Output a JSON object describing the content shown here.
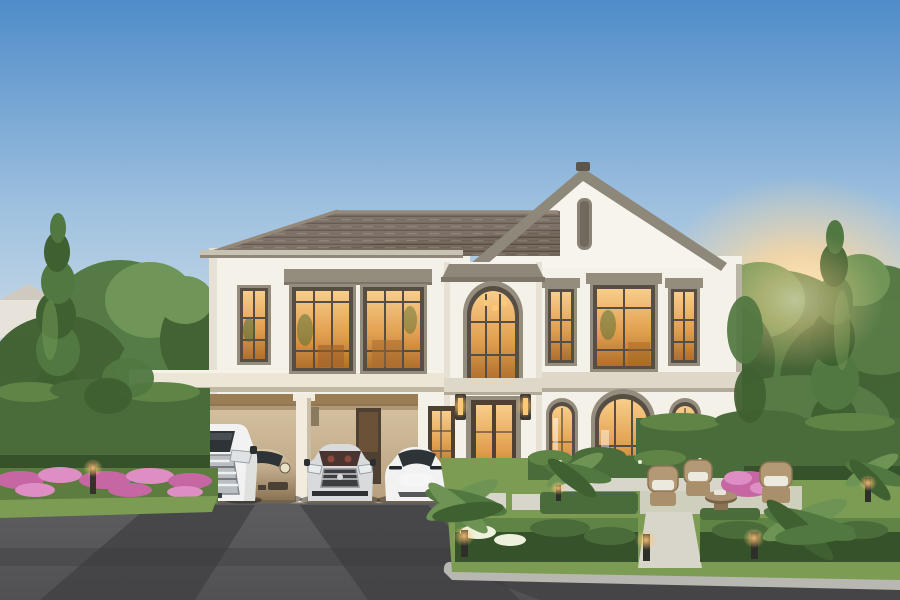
{
  "scene": {
    "type": "photorealistic architectural rendering",
    "subject": "luxury two-story detached house at dusk",
    "details": "cream stucco facade, gray tiled hip roof with front-facing gable and slit vent, central two-story arched window tower over front door, warm-lit windows, attached flat-roof carport sheltering four cars, landscaped formal garden with hedges, ferns, pink flowers, wicker patio chairs, bollard path lights, tall poplar trees, evening sun glow on the right"
  },
  "objects": {
    "cars": [
      {
        "name": "white-luxury-mpv",
        "position": "far left under carport"
      },
      {
        "name": "champagne-sports-car",
        "position": "second from left"
      },
      {
        "name": "silver-luxury-sedan",
        "position": "third from left"
      },
      {
        "name": "white-electric-sedan",
        "position": "right of carport"
      }
    ],
    "house_features": [
      "gable-vent",
      "arched-entry-tower",
      "front-door",
      "side-door",
      "wall-lanterns",
      "floor-band",
      "arched-ground-windows",
      "gridded-upper-windows"
    ],
    "garden_features": [
      "hedge-walls",
      "parterre-hedges",
      "stepping-stone-path",
      "walkway",
      "ferns",
      "pink-flower-beds",
      "wicker-chairs",
      "round-table",
      "bollard-lights",
      "poplar-trees"
    ]
  },
  "colors": {
    "sky_top": "#4f8cc9",
    "sky_mid": "#9fc1df",
    "sky_low": "#d3dfe8",
    "sky_horizon": "#e9e7db",
    "sun_glow": "#ffd89a",
    "sun_core": "#fff2d4",
    "wall": "#f4f1e9",
    "wall_shade": "#e6e1d4",
    "gable_wall": "#f7f4ee",
    "trim": "#948c7c",
    "band": "#ded8c9",
    "band_shadow": "#b3ab99",
    "frame": "#564e44",
    "glass_hi": "#f8cd8b",
    "glass_mid": "#e2a050",
    "glass_lo": "#b06f2c",
    "glass_dark": "#2e3337",
    "roof_base": "#76695e",
    "roof_dark": "#584f46",
    "roof_light": "#867a6e",
    "roof_trim": "#8e887a",
    "carport_wall_hi": "#d8c5a4",
    "carport_wall_lo": "#b49d7c",
    "carport_ceiling": "#9a7c55",
    "column": "#f2ecdf",
    "fascia": "#ece6d7",
    "door_dark": "#4e4134",
    "drive": "#5d5d5f",
    "drive_dark": "#3f3f41",
    "road": "#454548",
    "curb": "#b8b7b1",
    "lawn": "#7c9c54",
    "lawn_dark": "#5d7d40",
    "hedge": "#4a6c3a",
    "hedge_dark": "#36522a",
    "hedge_light": "#5f8546",
    "tree_dark": "#3f6030",
    "tree_mid": "#527841",
    "tree_light": "#6d9454",
    "trunk": "#5a4632",
    "flower_pink": "#c666a2",
    "flower_pink_light": "#df8ec4",
    "flower_white": "#eef2dd",
    "car_white": "#f1f2f1",
    "car_bronze": "#b7a183",
    "car_bronze_dark": "#8a7454",
    "car_silver": "#d8dadb",
    "chrome": "#c3c8cc",
    "light_warm": "#ffc875",
    "lantern": "#3d382f",
    "stone": "#d8d5ca",
    "distant_house": "#e7e3da",
    "distant_roof": "#cfc9bf"
  }
}
